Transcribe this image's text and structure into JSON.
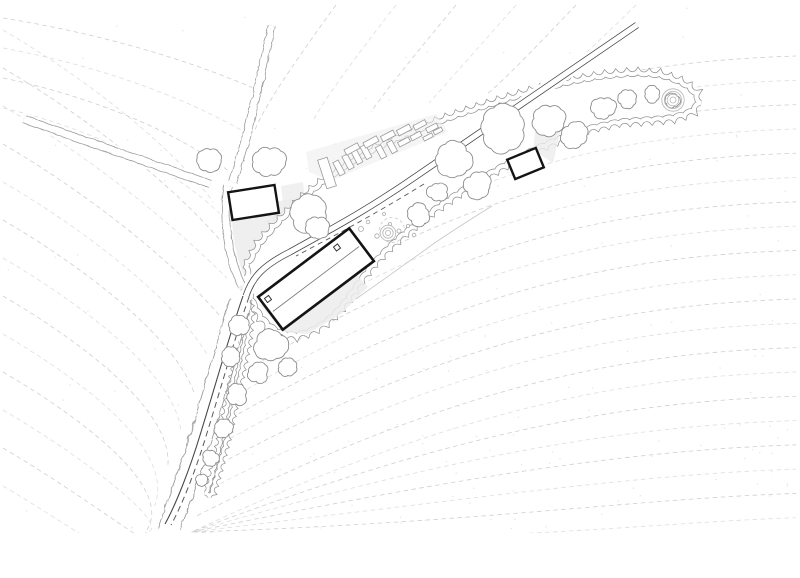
{
  "document": {
    "kind": "architectural site plan",
    "projection": "top-down plan view",
    "style": "monochrome hand-drafted line drawing on white paper",
    "description": "Site plan: two wavy hedge-lined lanes from the north and west meet a road that runs from the northeast and bends south; a long rotated main house with roof ridge and two chimneys sits at the bend; a small outbuilding stands at the lane junction and a garden shed sits inside a tapering cloud-outline tree belt that points northeast; vegetable garden beds, ring-symbol trees, stone dots, grey courtyard and terrace surfaces, dashed topographic contour lines and stipple texture fill the field."
  },
  "colors": {
    "paper": "#ffffff",
    "contour": "#cfcfcf",
    "contourLight": "#dedede",
    "stipple": "#e4e4e4",
    "hedge": "#9b9b9b",
    "canopy": "#8c8c8c",
    "road": "#474747",
    "boundaryDash": "#585858",
    "building": "#141414",
    "ridge": "#7a7a7a",
    "bedStroke": "#9a9a9a",
    "softGray": "#ececec",
    "detail": "#ababab"
  },
  "features": {
    "buildings": [
      {
        "name": "main-house",
        "form": "long rectangle rotated about 37 degrees with ridge line and two chimneys"
      },
      {
        "name": "north-outbuilding",
        "form": "small rectangle at the lane junction"
      },
      {
        "name": "garden-shed",
        "form": "small rectangle in the tree belt, one corner hidden by a canopy"
      }
    ],
    "roads": [
      {
        "name": "main-road",
        "form": "double solid line from the northeast bending south; the south leg has a solid west edge and dashed east edge"
      },
      {
        "name": "north-lane",
        "form": "double wavy hedge line"
      },
      {
        "name": "west-lane",
        "form": "double wavy hedge line"
      }
    ],
    "vegetation": {
      "hedgerow_belt": "tapering cloud-outline belt pointing northeast with a thin tail along the south road",
      "tree_canopies": 24,
      "ring_trees": 2,
      "garden_beds": 17
    },
    "terrain": {
      "contour_lines": "light dashed curves fanning around the valley",
      "stipple_dots": true
    },
    "surfaces": [
      "courtyard at junction",
      "terrace southeast of main house",
      "garden strip",
      "patch beside shed"
    ]
  }
}
